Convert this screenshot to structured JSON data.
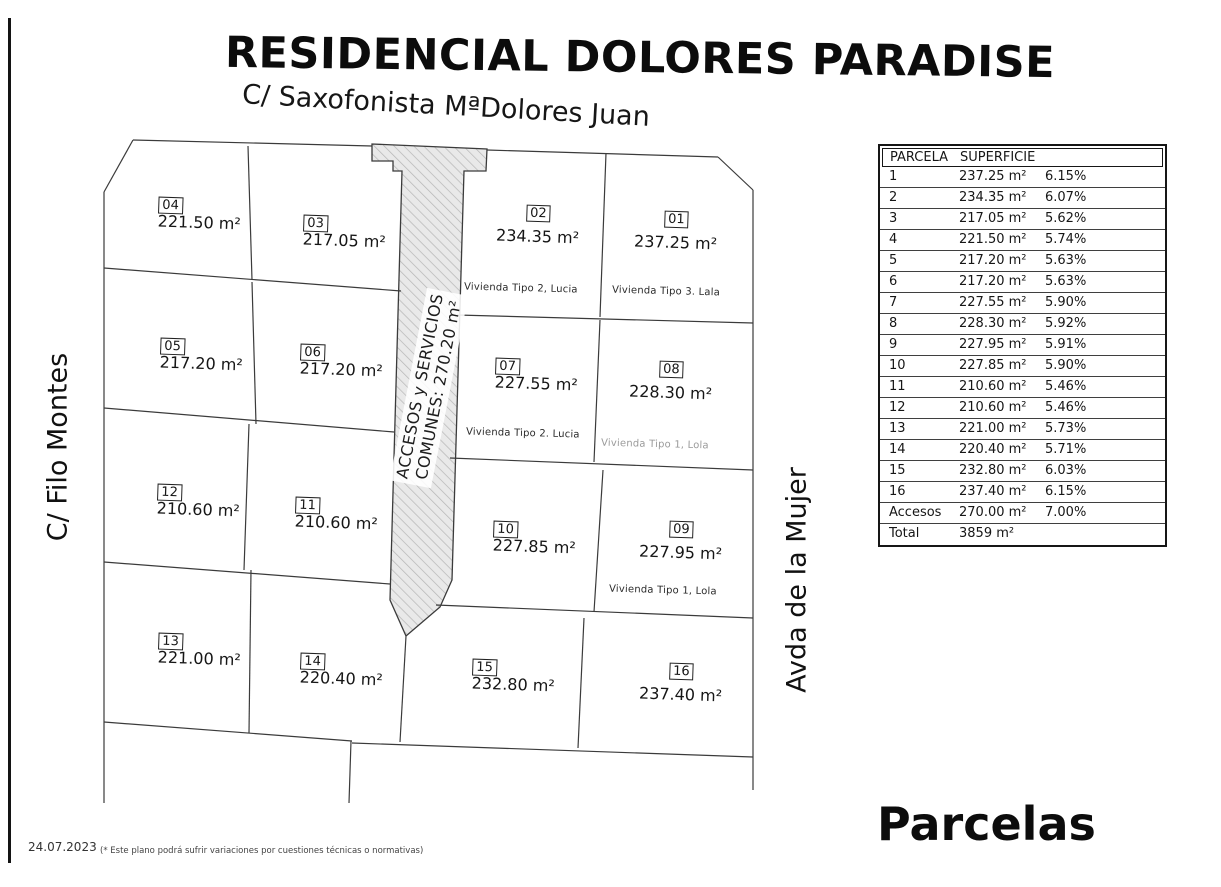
{
  "title": "RESIDENCIAL DOLORES PARADISE",
  "subtitle": "C/ Saxofonista MªDolores Juan",
  "plan": {
    "strip_line1": "ACCESOS y SERVICIOS",
    "strip_line2": "COMUNES: 270.20 m²",
    "street_left": "C/ Filo Montes",
    "street_right": "Avda de la Mujer"
  },
  "parcels": [
    {
      "num": "01",
      "area": "237.25 m²"
    },
    {
      "num": "02",
      "area": "234.35 m²"
    },
    {
      "num": "03",
      "area": "217.05 m²"
    },
    {
      "num": "04",
      "area": "221.50 m²"
    },
    {
      "num": "05",
      "area": "217.20 m²"
    },
    {
      "num": "06",
      "area": "217.20 m²"
    },
    {
      "num": "07",
      "area": "227.55 m²"
    },
    {
      "num": "08",
      "area": "228.30 m²"
    },
    {
      "num": "09",
      "area": "227.95 m²"
    },
    {
      "num": "10",
      "area": "227.85 m²"
    },
    {
      "num": "11",
      "area": "210.60 m²"
    },
    {
      "num": "12",
      "area": "210.60 m²"
    },
    {
      "num": "13",
      "area": "221.00 m²"
    },
    {
      "num": "14",
      "area": "220.40 m²"
    },
    {
      "num": "15",
      "area": "232.80 m²"
    },
    {
      "num": "16",
      "area": "237.40 m²"
    }
  ],
  "viviendas": [
    {
      "parcel": "02",
      "text": "Vivienda Tipo 2, Lucia"
    },
    {
      "parcel": "01",
      "text": "Vivienda Tipo 3. Lala"
    },
    {
      "parcel": "07",
      "text": "Vivienda Tipo 2. Lucia"
    },
    {
      "parcel": "08",
      "text": "Vivienda Tipo 1, Lola"
    },
    {
      "parcel": "09",
      "text": "Vivienda Tipo 1, Lola"
    }
  ],
  "table": {
    "headers": [
      "PARCELA",
      "SUPERFICIE"
    ],
    "rows": [
      [
        "1",
        "237.25 m²",
        "6.15%"
      ],
      [
        "2",
        "234.35 m²",
        "6.07%"
      ],
      [
        "3",
        "217.05 m²",
        "5.62%"
      ],
      [
        "4",
        "221.50 m²",
        "5.74%"
      ],
      [
        "5",
        "217.20 m²",
        "5.63%"
      ],
      [
        "6",
        "217.20 m²",
        "5.63%"
      ],
      [
        "7",
        "227.55 m²",
        "5.90%"
      ],
      [
        "8",
        "228.30 m²",
        "5.92%"
      ],
      [
        "9",
        "227.95 m²",
        "5.91%"
      ],
      [
        "10",
        "227.85 m²",
        "5.90%"
      ],
      [
        "11",
        "210.60 m²",
        "5.46%"
      ],
      [
        "12",
        "210.60 m²",
        "5.46%"
      ],
      [
        "13",
        "221.00 m²",
        "5.73%"
      ],
      [
        "14",
        "220.40 m²",
        "5.71%"
      ],
      [
        "15",
        "232.80 m²",
        "6.03%"
      ],
      [
        "16",
        "237.40 m²",
        "6.15%"
      ],
      [
        "Accesos",
        "270.00 m²",
        "7.00%"
      ],
      [
        "Total",
        "3859 m²",
        ""
      ]
    ]
  },
  "footer": {
    "caption": "Parcelas",
    "date": "24.07.2023",
    "note": "(*  Este plano podrá sufrir variaciones por cuestiones técnicas o normativas)"
  },
  "colors": {
    "ink": "#161616",
    "plan_line": "#3b3b3b",
    "strip_fill": "#e9e9e9",
    "strip_hatch": "#b5b5b5",
    "faded_text": "#9a9a9a"
  }
}
